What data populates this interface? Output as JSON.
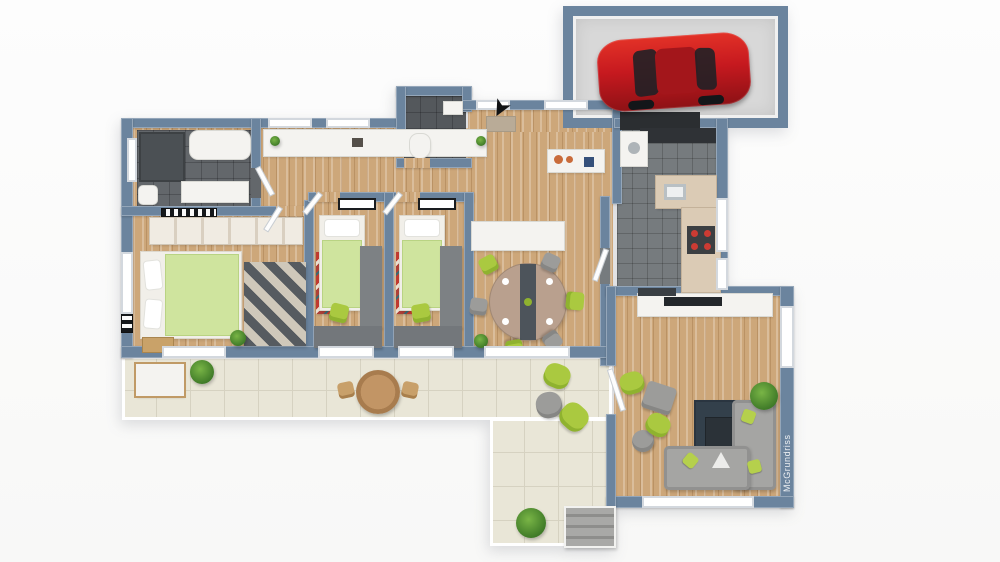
{
  "watermark": {
    "text": "McGrundriss"
  },
  "palette": {
    "background": "#fbfbfb",
    "wall": "#6b849e",
    "wood_floor": "#cda77a",
    "terrace_tile": "#e9e6d7",
    "bathroom_tile": "#63676b",
    "kitchen_tile": "#767b7e",
    "garage_floor": "#d8d8d8",
    "car_red": "#c6191f",
    "bed_green": "#cfe49e",
    "chair_green": "#aac940",
    "sofa_gray": "#a5a5a3",
    "rug_navy": "#33404b",
    "kid_rug_red": "#c03a30",
    "counter_beige": "#dbcbb5",
    "white_furniture": "#f4f3f0"
  },
  "rooms": [
    {
      "id": "garage",
      "floor": "concrete"
    },
    {
      "id": "utility",
      "floor": "dark-tile"
    },
    {
      "id": "bathroom",
      "floor": "dark-tile"
    },
    {
      "id": "wc",
      "floor": "dark-tile"
    },
    {
      "id": "hallway",
      "floor": "wood"
    },
    {
      "id": "entry",
      "floor": "wood"
    },
    {
      "id": "kitchen",
      "floor": "dark-tile"
    },
    {
      "id": "master-bedroom",
      "floor": "wood"
    },
    {
      "id": "kids-room-1",
      "floor": "wood"
    },
    {
      "id": "kids-room-2",
      "floor": "wood"
    },
    {
      "id": "dining-area",
      "floor": "wood"
    },
    {
      "id": "living-room",
      "floor": "wood"
    },
    {
      "id": "terrace",
      "floor": "light-tile"
    },
    {
      "id": "garden-steps",
      "floor": "concrete"
    }
  ],
  "furniture": {
    "garage": [
      "red-car"
    ],
    "bathroom": [
      "shower",
      "bathtub",
      "vanity",
      "toilet"
    ],
    "wc": [
      "toilet",
      "hand-basin"
    ],
    "hallway": [
      "sideboard",
      "decor-plant"
    ],
    "entry": [
      "console-table",
      "doormat",
      "entrance-arrow"
    ],
    "kitchen": [
      "counter-with-sink",
      "counter-with-stove",
      "washer",
      "upper-dark-cabinets"
    ],
    "master-bedroom": [
      "double-bed-green",
      "wardrobe-row",
      "zigzag-rug",
      "nightstand",
      "radiator",
      "plant"
    ],
    "kids-room-1": [
      "single-bed-green",
      "red-rug",
      "desk",
      "green-chair",
      "wardrobe",
      "wall-radiator"
    ],
    "kids-room-2": [
      "single-bed-green",
      "red-rug",
      "desk",
      "green-chair",
      "wardrobe",
      "wall-radiator"
    ],
    "dining-area": [
      "round-table-with-runner",
      "green-chairs",
      "gray-chairs",
      "sideboard",
      "plant"
    ],
    "living-room": [
      "tv-sideboard",
      "corner-sofa-gray",
      "green-cushions",
      "navy-rug",
      "coffee-table",
      "armchair",
      "pouf",
      "beanbags-green",
      "plant"
    ],
    "terrace": [
      "bench",
      "round-wood-table",
      "two-wood-chairs",
      "beanbags",
      "potted-plants"
    ]
  }
}
